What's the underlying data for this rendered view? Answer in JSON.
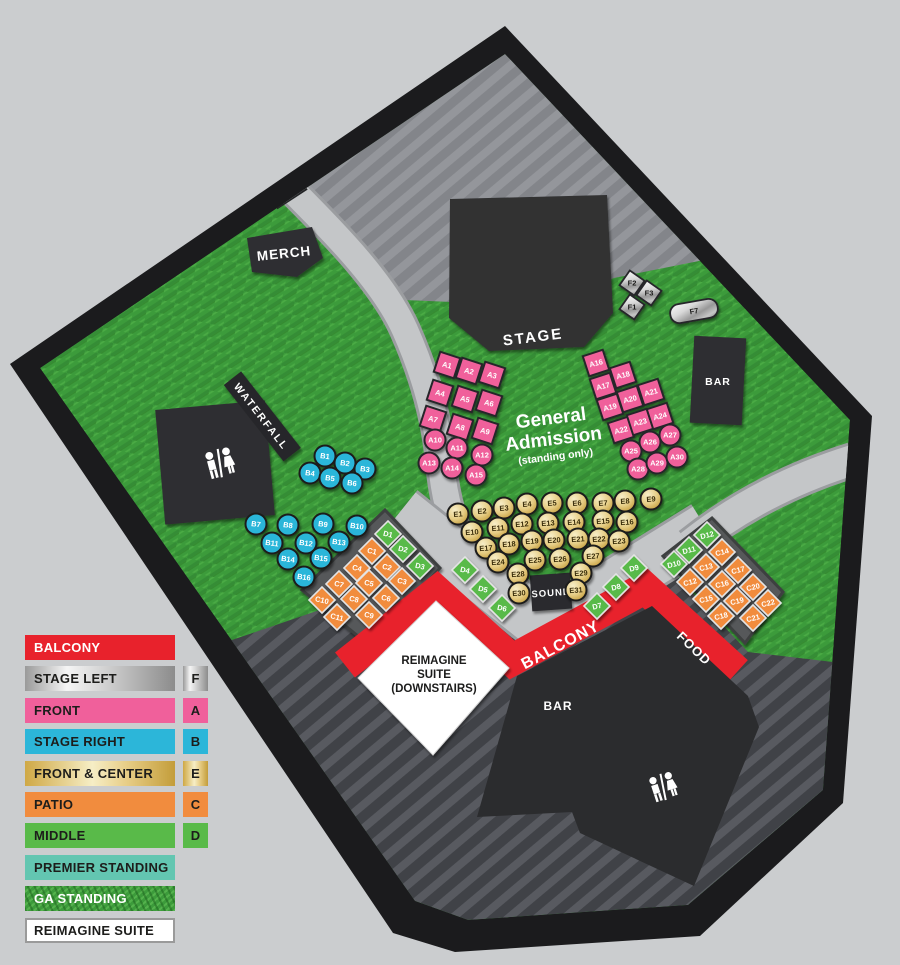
{
  "colors": {
    "red": "#e8222c",
    "pink": "#f0609b",
    "cyan": "#2cb6d9",
    "orange": "#f18c3e",
    "green": "#59ba49",
    "teal": "#63c6b1",
    "grass": "#3c9b3b",
    "charcoal": "#2e2f31",
    "white": "#ffffff"
  },
  "legend": {
    "items": [
      {
        "label": "BALCONY",
        "swatch": "red",
        "white_text": true
      },
      {
        "label": "STAGE LEFT",
        "swatch": "silver",
        "letter": "F"
      },
      {
        "label": "FRONT",
        "swatch": "pink",
        "letter": "A"
      },
      {
        "label": "STAGE RIGHT",
        "swatch": "cyan",
        "letter": "B"
      },
      {
        "label": "FRONT & CENTER",
        "swatch": "gold",
        "letter": "E"
      },
      {
        "label": "PATIO",
        "swatch": "orange",
        "letter": "C"
      },
      {
        "label": "MIDDLE",
        "swatch": "green",
        "letter": "D"
      },
      {
        "label": "PREMIER STANDING",
        "swatch": "teal"
      },
      {
        "label": "GA STANDING",
        "swatch": "grass",
        "white_text": true
      },
      {
        "label": "REIMAGINE SUITE",
        "swatch": "white"
      }
    ]
  },
  "map": {
    "labels": {
      "stage": "STAGE",
      "merch": "MERCH",
      "waterfall": "WATERFALL",
      "sound": "SOUND",
      "bar_stage": "BAR",
      "bar_main": "BAR",
      "balcony": "BALCONY",
      "food": "FOOD",
      "suite": [
        "REIMAGINE",
        "SUITE",
        "(DOWNSTAIRS)"
      ],
      "ga": [
        "General",
        "Admission",
        "(standing only)"
      ]
    },
    "sections": [
      {
        "name": "front-a-left",
        "shape": "square",
        "rot": 18,
        "labelRot": 14,
        "color": "pink",
        "stroke": "#26262a",
        "strokeW": 2,
        "labelColor": "#ffffff",
        "items": [
          [
            "A1",
            447,
            365
          ],
          [
            "A2",
            469,
            371
          ],
          [
            "A3",
            492,
            375
          ],
          [
            "A4",
            440,
            393
          ],
          [
            "A5",
            465,
            399
          ],
          [
            "A6",
            489,
            403
          ],
          [
            "A7",
            433,
            419
          ],
          [
            "A8",
            460,
            427
          ],
          [
            "A9",
            485,
            431
          ]
        ]
      },
      {
        "name": "front-a-left-rounds",
        "shape": "circle",
        "color": "pink",
        "stroke": "#26262a",
        "strokeW": 2,
        "labelColor": "#ffffff",
        "items": [
          [
            "A10",
            435,
            440
          ],
          [
            "A11",
            457,
            448
          ],
          [
            "A12",
            482,
            455
          ],
          [
            "A13",
            429,
            463
          ],
          [
            "A14",
            452,
            468
          ],
          [
            "A15",
            476,
            475
          ]
        ]
      },
      {
        "name": "front-a-right",
        "shape": "square",
        "rot": -18,
        "labelRot": -14,
        "color": "pink",
        "stroke": "#26262a",
        "strokeW": 2,
        "labelColor": "#ffffff",
        "items": [
          [
            "A16",
            596,
            363
          ],
          [
            "A17",
            603,
            386
          ],
          [
            "A18",
            623,
            375
          ],
          [
            "A19",
            610,
            407
          ],
          [
            "A20",
            630,
            399
          ],
          [
            "A21",
            651,
            392
          ],
          [
            "A22",
            621,
            430
          ],
          [
            "A23",
            640,
            422
          ],
          [
            "A24",
            660,
            416
          ]
        ]
      },
      {
        "name": "front-a-right-rounds",
        "shape": "circle",
        "color": "pink",
        "stroke": "#26262a",
        "strokeW": 2,
        "labelColor": "#ffffff",
        "items": [
          [
            "A25",
            631,
            451
          ],
          [
            "A26",
            650,
            442
          ],
          [
            "A27",
            670,
            435
          ],
          [
            "A28",
            638,
            469
          ],
          [
            "A29",
            657,
            463
          ],
          [
            "A30",
            677,
            457
          ]
        ]
      },
      {
        "name": "stage-right-b",
        "shape": "circle",
        "color": "cyan",
        "labelRot": 8,
        "stroke": "#1d1d1b",
        "strokeW": 2,
        "labelColor": "#ffffff",
        "items": [
          [
            "B1",
            325,
            456
          ],
          [
            "B2",
            345,
            463
          ],
          [
            "B3",
            365,
            469
          ],
          [
            "B4",
            310,
            473
          ],
          [
            "B5",
            330,
            478
          ],
          [
            "B6",
            352,
            483
          ],
          [
            "B7",
            256,
            524
          ],
          [
            "B8",
            288,
            525
          ],
          [
            "B9",
            323,
            524
          ],
          [
            "B10",
            357,
            526
          ],
          [
            "B11",
            272,
            543
          ],
          [
            "B12",
            306,
            543
          ],
          [
            "B13",
            339,
            542
          ],
          [
            "B14",
            288,
            559
          ],
          [
            "B15",
            321,
            558
          ],
          [
            "B16",
            304,
            577
          ]
        ]
      },
      {
        "name": "front-center-e",
        "shape": "circle",
        "fill": "url(#goldGrad)",
        "labelRot": -4,
        "stroke": "#1d1d1b",
        "strokeW": 2,
        "labelColor": "#3a2d08",
        "items": [
          [
            "E1",
            458,
            514
          ],
          [
            "E2",
            482,
            511
          ],
          [
            "E3",
            504,
            508
          ],
          [
            "E4",
            527,
            504
          ],
          [
            "E5",
            552,
            503
          ],
          [
            "E6",
            577,
            503
          ],
          [
            "E7",
            603,
            503
          ],
          [
            "E8",
            625,
            501
          ],
          [
            "E9",
            651,
            499
          ],
          [
            "E10",
            472,
            532
          ],
          [
            "E11",
            498,
            528
          ],
          [
            "E12",
            522,
            524
          ],
          [
            "E13",
            548,
            523
          ],
          [
            "E14",
            574,
            522
          ],
          [
            "E15",
            603,
            521
          ],
          [
            "E16",
            627,
            522
          ],
          [
            "E17",
            486,
            548
          ],
          [
            "E18",
            509,
            544
          ],
          [
            "E19",
            532,
            541
          ],
          [
            "E20",
            554,
            540
          ],
          [
            "E21",
            578,
            539
          ],
          [
            "E22",
            599,
            539
          ],
          [
            "E23",
            619,
            541
          ],
          [
            "E24",
            498,
            562
          ],
          [
            "E25",
            535,
            560
          ],
          [
            "E26",
            560,
            559
          ],
          [
            "E27",
            593,
            556
          ],
          [
            "E28",
            518,
            574
          ],
          [
            "E29",
            581,
            573
          ],
          [
            "E30",
            519,
            593
          ],
          [
            "E31",
            576,
            590
          ]
        ]
      },
      {
        "name": "patio-c-left",
        "shape": "diamond",
        "color": "orange",
        "labelRot": 14,
        "stroke": "#e4e4e4",
        "strokeW": 1.6,
        "labelColor": "#ffffff",
        "items": [
          [
            "C1",
            372,
            551
          ],
          [
            "C2",
            387,
            567
          ],
          [
            "C3",
            402,
            581
          ],
          [
            "C4",
            357,
            568
          ],
          [
            "C5",
            369,
            583
          ],
          [
            "C6",
            386,
            598
          ],
          [
            "C7",
            339,
            584
          ],
          [
            "C8",
            354,
            599
          ],
          [
            "C9",
            369,
            615
          ],
          [
            "C10",
            322,
            600
          ],
          [
            "C11",
            337,
            617
          ]
        ]
      },
      {
        "name": "patio-c-right",
        "shape": "diamond",
        "color": "orange",
        "labelRot": -14,
        "stroke": "#e4e4e4",
        "strokeW": 1.6,
        "labelColor": "#ffffff",
        "items": [
          [
            "C12",
            690,
            582
          ],
          [
            "C13",
            706,
            567
          ],
          [
            "C14",
            722,
            552
          ],
          [
            "C15",
            706,
            599
          ],
          [
            "C16",
            722,
            584
          ],
          [
            "C17",
            738,
            570
          ],
          [
            "C18",
            721,
            616
          ],
          [
            "C19",
            737,
            601
          ],
          [
            "C20",
            753,
            587
          ],
          [
            "C21",
            753,
            618
          ],
          [
            "C22",
            768,
            603
          ]
        ]
      },
      {
        "name": "middle-d-left",
        "shape": "diamond",
        "color": "green",
        "labelRot": 14,
        "stroke": "#e4e4e4",
        "strokeW": 1.6,
        "labelColor": "#ffffff",
        "items": [
          [
            "D1",
            388,
            534
          ],
          [
            "D2",
            403,
            549
          ],
          [
            "D3",
            420,
            566
          ],
          [
            "D4",
            465,
            570
          ],
          [
            "D5",
            483,
            589
          ],
          [
            "D6",
            502,
            608
          ]
        ]
      },
      {
        "name": "middle-d-right",
        "shape": "diamond",
        "color": "green",
        "labelRot": -14,
        "stroke": "#e4e4e4",
        "strokeW": 1.6,
        "labelColor": "#ffffff",
        "items": [
          [
            "D7",
            597,
            606
          ],
          [
            "D8",
            616,
            587
          ],
          [
            "D9",
            634,
            568
          ],
          [
            "D10",
            674,
            564
          ],
          [
            "D11",
            689,
            550
          ],
          [
            "D12",
            707,
            535
          ]
        ]
      },
      {
        "name": "stage-left-f",
        "shape": "square",
        "size": 18,
        "rot": 35,
        "labelRot": 0,
        "fill": "url(#silverGrad)",
        "stroke": "#26262a",
        "strokeW": 1.8,
        "labelColor": "#1d1d1b",
        "items": [
          [
            "F1",
            632,
            307
          ],
          [
            "F2",
            632,
            283
          ],
          [
            "F3",
            649,
            293
          ]
        ]
      },
      {
        "name": "stage-left-f7",
        "shape": "pill",
        "rot": -10,
        "labelRot": -10,
        "fill": "url(#silverGrad)",
        "stroke": "#26262a",
        "strokeW": 1.8,
        "labelColor": "#1d1d1b",
        "items": [
          [
            "F7",
            694,
            311
          ]
        ]
      }
    ]
  }
}
